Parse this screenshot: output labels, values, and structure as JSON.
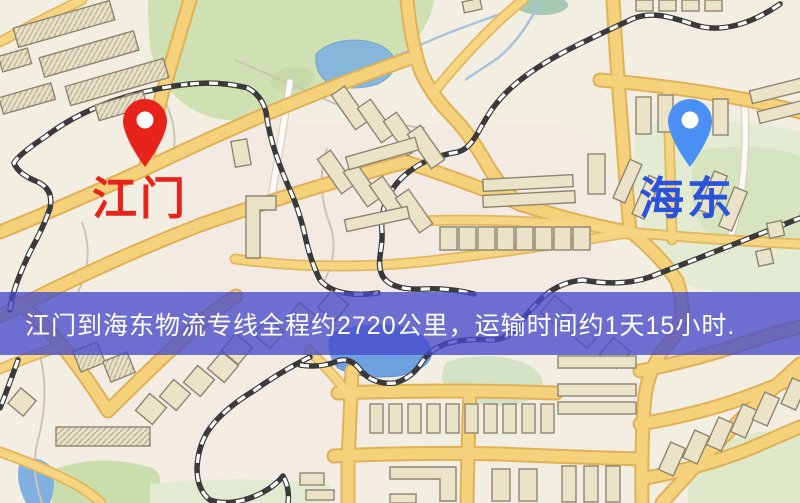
{
  "map": {
    "canvas": {
      "width": 800,
      "height": 503
    },
    "origin": {
      "name": "江门",
      "pin": "red-location-pin",
      "pin_color": "#e8231c",
      "label_color": "#e8231c"
    },
    "destination": {
      "name": "海东",
      "pin": "blue-location-pin",
      "pin_color": "#4a90f5",
      "label_color": "#2b52dd"
    },
    "banner": {
      "text": "江门到海东物流专线全程约2720公里，运输时间约1天15小时.",
      "background": "rgba(72,74,203,0.78)",
      "text_color": "#ffffff"
    }
  },
  "palette": {
    "map_background": "#f2eee2",
    "road_major": "#f4d17a",
    "road_casing": "#e0b158",
    "water": "#86b6da",
    "water_deep": "#6fa1e2",
    "park_green": "#cfe0b2",
    "building": "#ebe3c8",
    "railway": "#3a3a3a"
  }
}
